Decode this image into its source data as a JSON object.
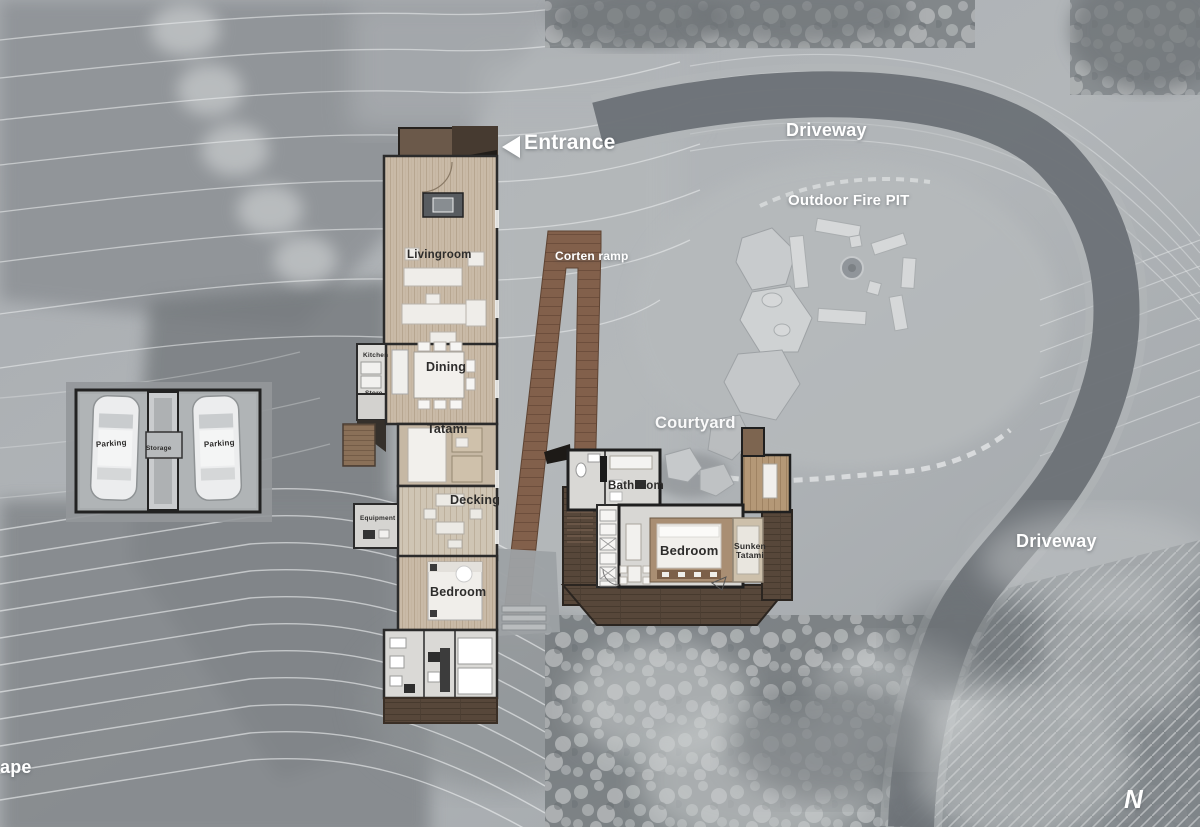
{
  "document": {
    "kind": "architectural site plan, aerial top view"
  },
  "site": {
    "entrance": "Entrance",
    "driveway_top": "Driveway",
    "outdoor_fire_pit": "Outdoor Fire PIT",
    "corten_ramp": "Corten ramp",
    "courtyard": "Courtyard",
    "driveway_right": "Driveway",
    "landscape_partial": "ape",
    "north_mark": "N"
  },
  "main_house": {
    "livingroom": "Livingroom",
    "kitchen": "Kitchen",
    "store": "Store",
    "dining": "Dining",
    "tatami": "Tatami",
    "decking": "Decking",
    "equipment": "Equipment",
    "bedroom": "Bedroom"
  },
  "annex": {
    "bathroom": "Bathroom",
    "bedroom": "Bedroom",
    "sunken_tatami": "Sunken Tatami"
  },
  "garage": {
    "parking_left": "Parking",
    "storage": "Storage",
    "parking_right": "Parking"
  },
  "colors": {
    "label_light": "#ffffff",
    "label_dark": "#2d2c2b",
    "corten_steel": "#82604b",
    "deck_wood_dark": "#57473a",
    "floor_wood_light": "#c9baa7",
    "annex_wood": "#b49877",
    "road_asphalt": "#6c7176",
    "concrete": "#a9adaf"
  }
}
